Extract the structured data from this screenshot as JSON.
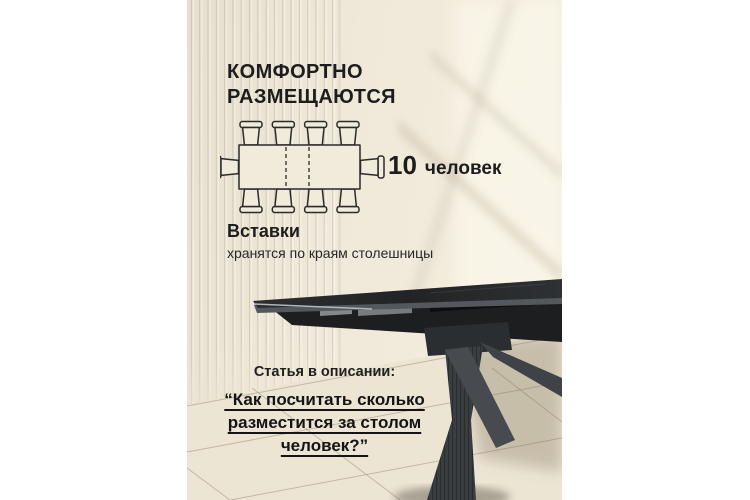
{
  "header": {
    "title_line1": "КОМФОРТНО",
    "title_line2": "РАЗМЕЩАЮТСЯ"
  },
  "capacity": {
    "number": "10",
    "unit": "человек"
  },
  "inserts": {
    "title": "Вставки",
    "subtitle": "хранятся по краям столешницы"
  },
  "article": {
    "lead": "Статья в описании:",
    "quote_line1": "“Как посчитать сколько",
    "quote_line2": "разместится за столом",
    "quote_line3": "человек?”"
  },
  "diagram": {
    "seats": {
      "top": 4,
      "bottom": 4,
      "left": 1,
      "right": 1
    },
    "seats_total": 10
  },
  "colors": {
    "text": "#1d1d1d",
    "wall": "#f0e9d9",
    "tabletop": "#26282a",
    "leg": "#3a3e41"
  }
}
